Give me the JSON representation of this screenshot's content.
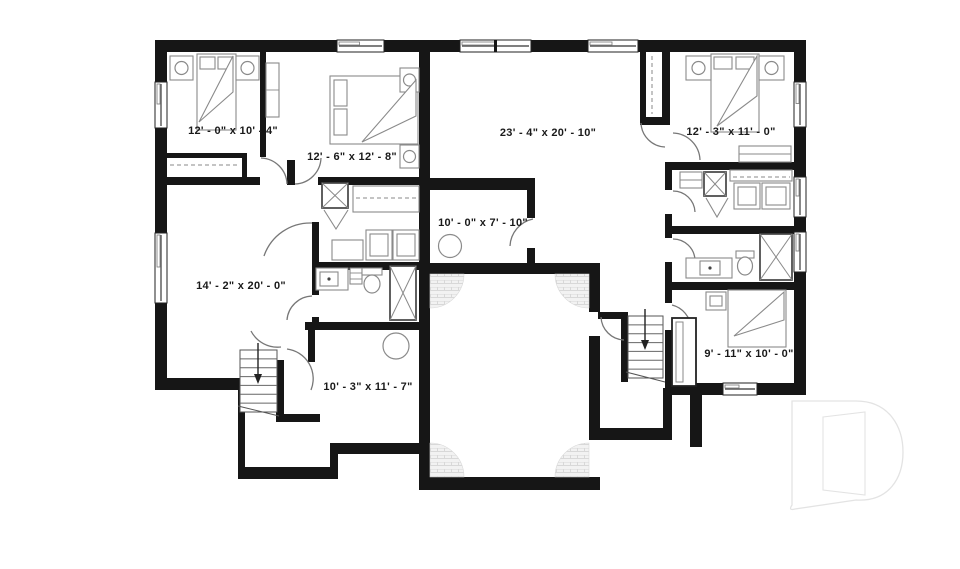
{
  "plan": {
    "title": "basement floor plan",
    "rooms": [
      {
        "id": "bedroom-top-left",
        "label": "12' - 0\" x 10' - 4\""
      },
      {
        "id": "bedroom-left-2",
        "label": "12' - 6\" x 12' - 8\""
      },
      {
        "id": "great-room",
        "label": "23' - 4\" x 20' - 10\""
      },
      {
        "id": "bedroom-top-right",
        "label": "12' - 3\" x 11' - 0\""
      },
      {
        "id": "utility-room",
        "label": "10' - 0\" x 7' - 10\""
      },
      {
        "id": "family-room-left",
        "label": "14' - 2\" x 20' - 0\""
      },
      {
        "id": "office-room",
        "label": "10' - 3\" x 11' - 7\""
      },
      {
        "id": "bedroom-bottom-right",
        "label": "9' - 11\" x 10' - 0\""
      }
    ],
    "watermark": {
      "letter_shape": "stylized-D-logo"
    }
  },
  "colors": {
    "wall": "#161616",
    "furniture": "#8a8a8a",
    "fixture": "#444444",
    "label": "#1a1a1a",
    "door_arc": "#777777",
    "hatch_bg": "#f2f2f2",
    "hatch_line": "#d8d8d8",
    "watermark": "#e3e3e3"
  }
}
